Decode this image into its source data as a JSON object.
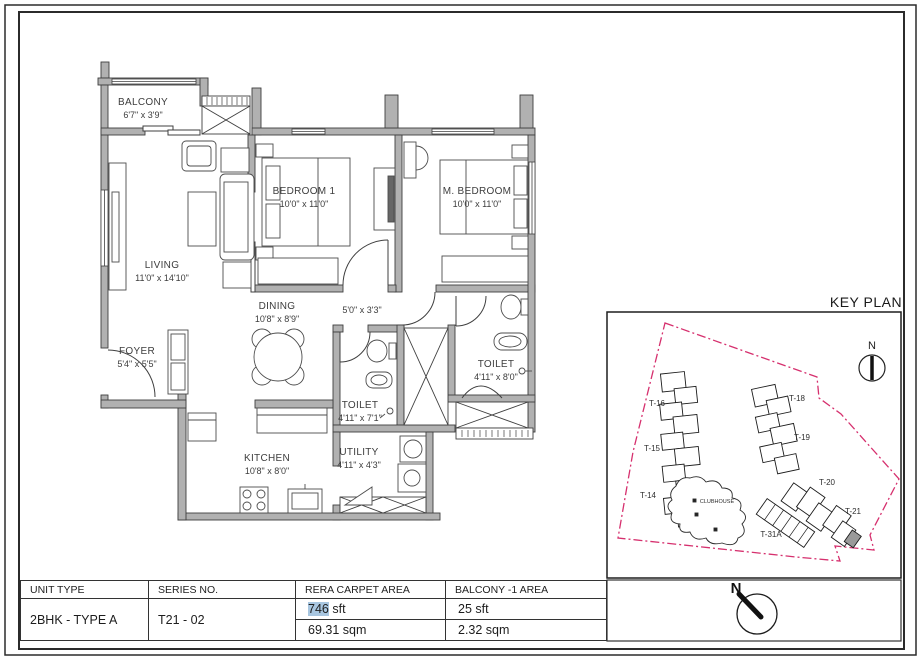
{
  "floor_plan": {
    "rooms": [
      {
        "name": "BALCONY",
        "dims": "6'7\" x 3'9\""
      },
      {
        "name": "LIVING",
        "dims": "11'0\" x 14'10\""
      },
      {
        "name": "FOYER",
        "dims": "5'4\" x 5'5\""
      },
      {
        "name": "BEDROOM 1",
        "dims": "10'0\" x 11'0\""
      },
      {
        "name": "M. BEDROOM",
        "dims": "10'0\" x 11'0\""
      },
      {
        "name": "DINING",
        "dims": "10'8\" x 8'9\""
      },
      {
        "name": "",
        "dims": "5'0\" x 3'3\""
      },
      {
        "name": "TOILET",
        "dims": "4'11\" x 8'0\""
      },
      {
        "name": "TOILET",
        "dims": "4'11\" x 7'1\""
      },
      {
        "name": "KITCHEN",
        "dims": "10'8\" x 8'0\""
      },
      {
        "name": "UTILITY",
        "dims": "4'11\" x 4'3\""
      }
    ]
  },
  "key_plan": {
    "title": "KEY PLAN",
    "north_label": "N",
    "towers": [
      "T-16",
      "T-15",
      "T-14",
      "T-18",
      "T-19",
      "T-20",
      "T-21",
      "T-31A"
    ],
    "clubhouse_label": "CLUBHOUSE",
    "boundary_color": "#d6306e",
    "highlighted_tower": "T-21"
  },
  "compass": {
    "north_label": "N"
  },
  "info_table": {
    "headers": [
      "UNIT TYPE",
      "SERIES NO.",
      "RERA CARPET AREA",
      "BALCONY -1  AREA"
    ],
    "unit_type": "2BHK - TYPE A",
    "series_no": "T21 - 02",
    "rera_carpet_area": {
      "sft_value": "746",
      "sft_unit": "sft",
      "sqm": "69.31 sqm"
    },
    "balcony_area": {
      "sft": "25 sft",
      "sqm": "2.32 sqm"
    },
    "highlight_color": "#a8c6e0"
  }
}
